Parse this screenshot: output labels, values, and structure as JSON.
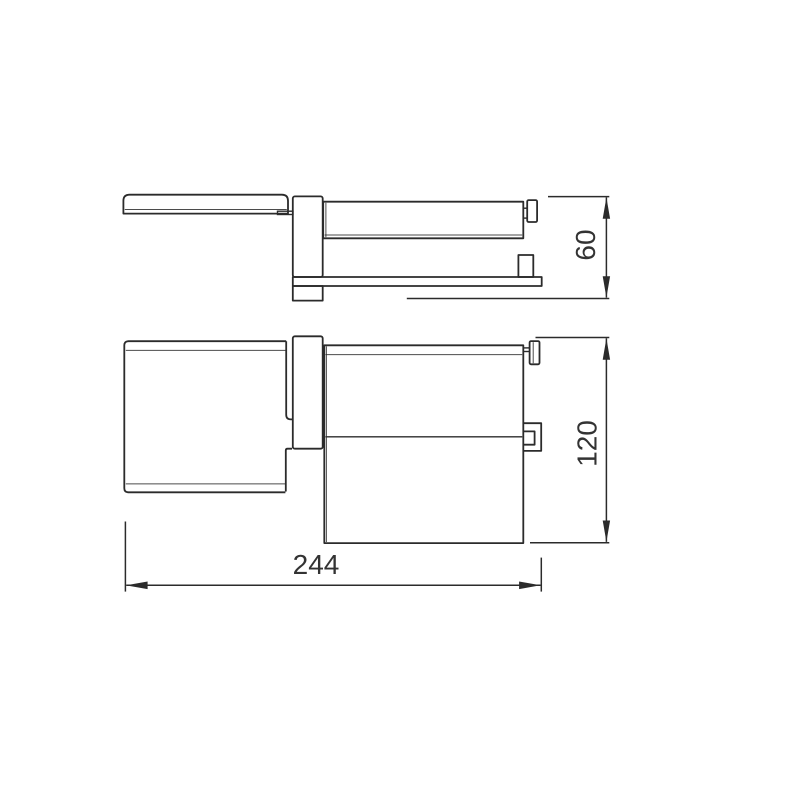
{
  "page": {
    "background": "#ffffff"
  },
  "drawing": {
    "line_color": "#2b2b2b",
    "label_color": "#333333",
    "dimensions": {
      "depth": {
        "label": "60"
      },
      "height": {
        "label": "120"
      },
      "width": {
        "label": "244"
      }
    }
  }
}
